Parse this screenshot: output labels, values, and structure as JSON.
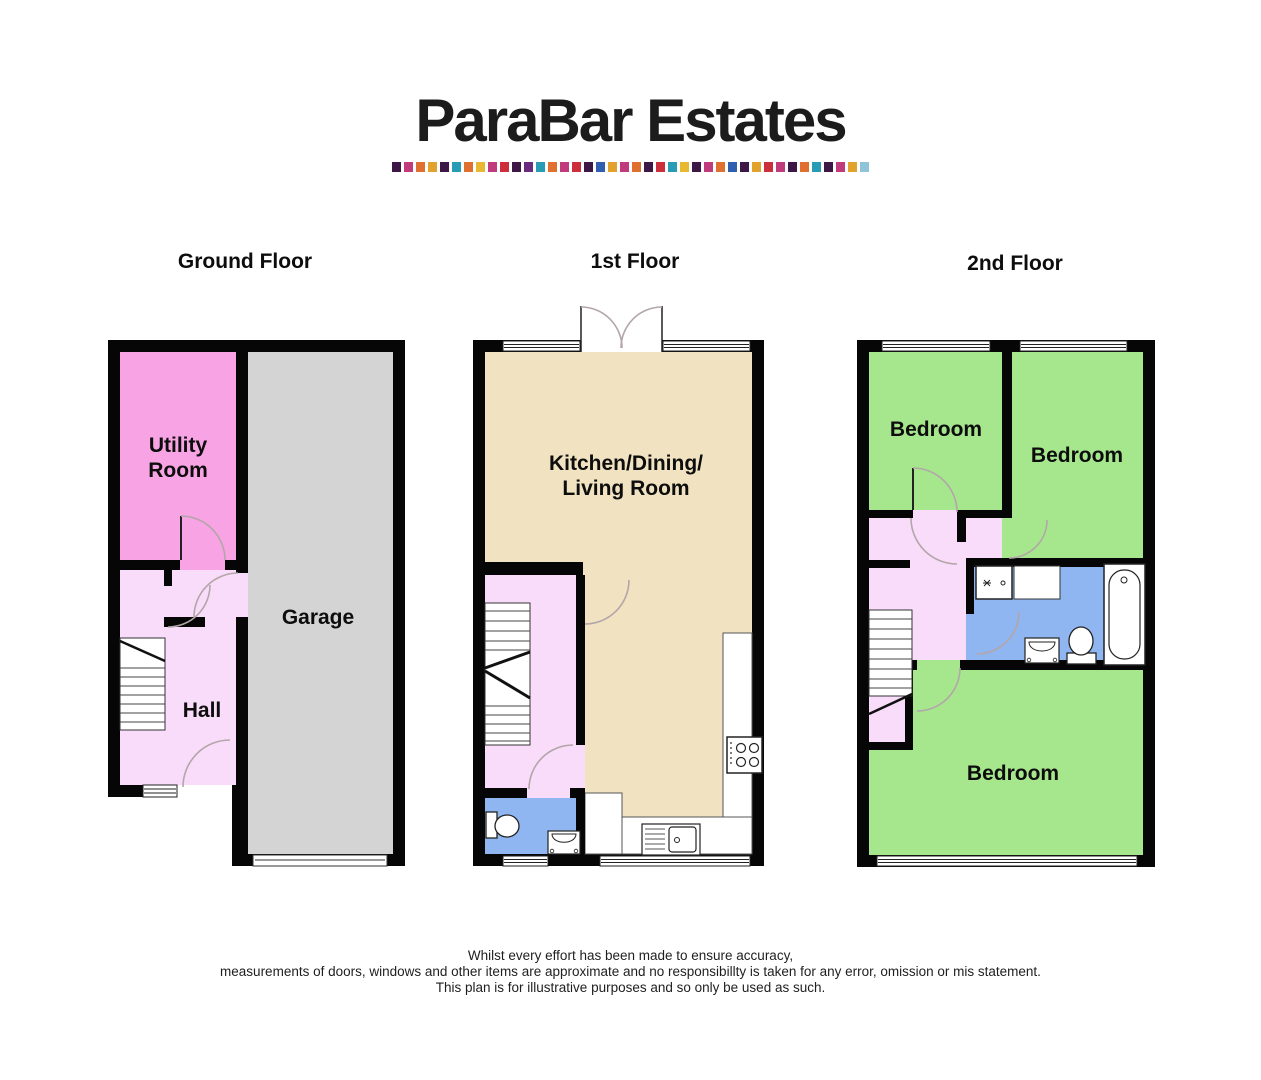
{
  "logo": {
    "title": "ParaBar Estates",
    "strip_colors": [
      "#3d1746",
      "#c13a7c",
      "#df7030",
      "#e1a32e",
      "#3d1746",
      "#2a9bb4",
      "#df7030",
      "#e8b832",
      "#c13a7c",
      "#cc2f3b",
      "#3d1746",
      "#6a2a7e",
      "#2a9bb4",
      "#df7030",
      "#c13a7c",
      "#cc2f3b",
      "#3d1746",
      "#2f5fae",
      "#e1a32e",
      "#c13a7c",
      "#df7030",
      "#3d1746",
      "#cc2f3b",
      "#2a9bb4",
      "#e8b832",
      "#3d1746",
      "#c13a7c",
      "#df7030",
      "#2f5fae",
      "#3d1746",
      "#e1a32e",
      "#cc2f3b",
      "#c13a7c",
      "#3d1746",
      "#df7030",
      "#2a9bb4",
      "#3d1746",
      "#c13a7c",
      "#e1a32e",
      "#8fc3d8"
    ]
  },
  "floors": {
    "ground": {
      "title": "Ground Floor",
      "rooms": {
        "utility_line1": "Utility",
        "utility_line2": "Room",
        "garage": "Garage",
        "hall": "Hall"
      }
    },
    "first": {
      "title": "1st Floor",
      "rooms": {
        "kitchen_line1": "Kitchen/Dining/",
        "kitchen_line2": "Living Room"
      }
    },
    "second": {
      "title": "2nd Floor",
      "rooms": {
        "bedroom_front_left": "Bedroom",
        "bedroom_front_right": "Bedroom",
        "bedroom_rear": "Bedroom"
      }
    }
  },
  "colors": {
    "wall": "#060606",
    "utility_pink": "#f8a4e4",
    "hall_pink": "#f9dcf9",
    "garage_gray": "#d4d4d4",
    "kitchen_beige": "#f1e3c2",
    "bathroom_blue": "#8fb6f0",
    "bedroom_green": "#a6e78e",
    "door_arc": "#b3a6a8"
  },
  "disclaimer": {
    "line1": "Whilst every effort has been made to ensure accuracy,",
    "line2": "measurements of doors, windows and other items are approximate and no responsibillty is taken for any error, omission or mis statement.",
    "line3": "This plan is for illustrative purposes and so only be used as such."
  }
}
